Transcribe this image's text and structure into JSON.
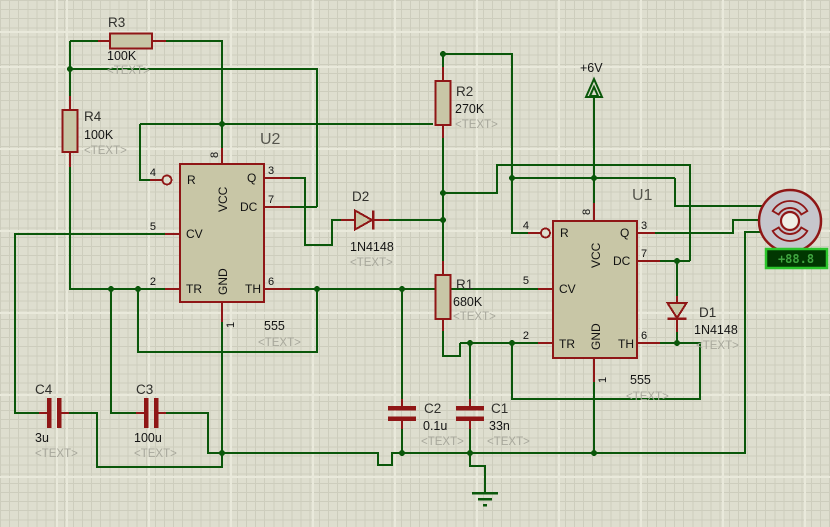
{
  "app": {
    "name": "schematic-capture-canvas",
    "canvas_bg": "#dedecf"
  },
  "colors": {
    "wire_green": "#0a570a",
    "component_red": "#8f1616",
    "body_fill": "#c8c6a6",
    "placeholder_gray": "#a8a89c",
    "display_border": "#2bc52b",
    "display_bg": "#013701",
    "display_text": "#3fa43f"
  },
  "power": {
    "label": "+6V"
  },
  "display": {
    "value": "+88.8"
  },
  "timer_pins": {
    "r": {
      "num": "4",
      "name": "R"
    },
    "vcc": {
      "num": "8",
      "name": "VCC"
    },
    "q": {
      "num": "3",
      "name": "Q"
    },
    "dc": {
      "num": "7",
      "name": "DC"
    },
    "cv": {
      "num": "5",
      "name": "CV"
    },
    "tr": {
      "num": "2",
      "name": "TR"
    },
    "th": {
      "num": "6",
      "name": "TH"
    },
    "gnd": {
      "num": "1",
      "name": "GND"
    }
  },
  "components": {
    "u1": {
      "ref": "U1",
      "part": "555",
      "text": "<TEXT>"
    },
    "u2": {
      "ref": "U2",
      "part": "555",
      "text": "<TEXT>"
    },
    "r1": {
      "ref": "R1",
      "value": "680K",
      "text": "<TEXT>"
    },
    "r2": {
      "ref": "R2",
      "value": "270K",
      "text": "<TEXT>"
    },
    "r3": {
      "ref": "R3",
      "value": "100K",
      "text": "<TEXT>"
    },
    "r4": {
      "ref": "R4",
      "value": "100K",
      "text": "<TEXT>"
    },
    "c1": {
      "ref": "C1",
      "value": "33n",
      "text": "<TEXT>"
    },
    "c2": {
      "ref": "C2",
      "value": "0.1u",
      "text": "<TEXT>"
    },
    "c3": {
      "ref": "C3",
      "value": "100u",
      "text": "<TEXT>"
    },
    "c4": {
      "ref": "C4",
      "value": "3u",
      "text": "<TEXT>"
    },
    "d1": {
      "ref": "D1",
      "value": "1N4148",
      "text": "<TEXT>"
    },
    "d2": {
      "ref": "D2",
      "value": "1N4148",
      "text": "<TEXT>"
    }
  }
}
